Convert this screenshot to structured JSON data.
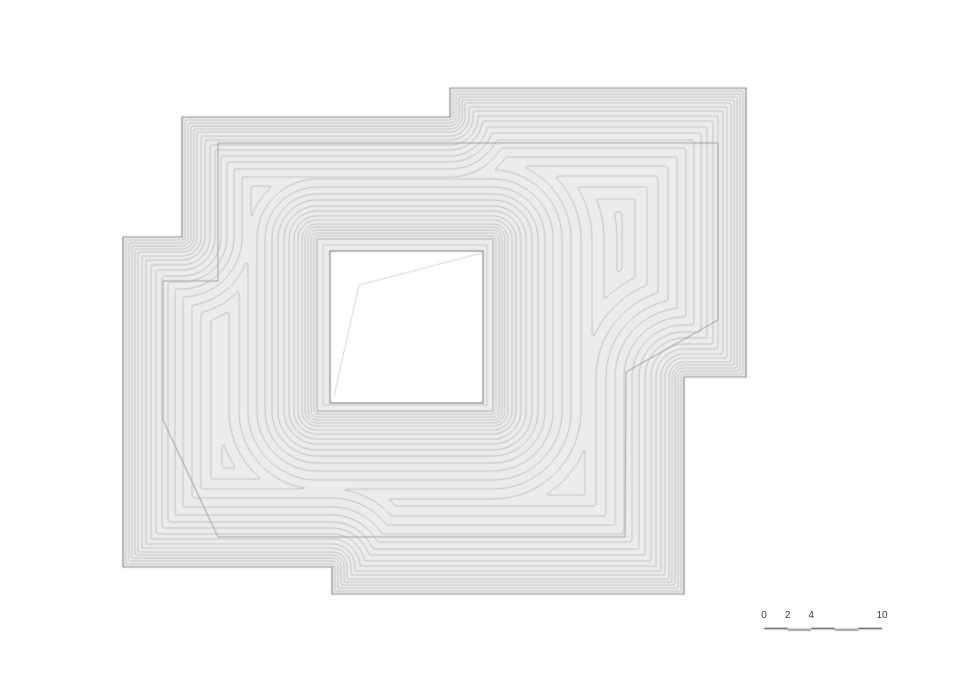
{
  "page": {
    "background": "#ffffff"
  },
  "drawing": {
    "width": 960,
    "height": 678,
    "colors": {
      "fill": "#ececec",
      "contour": "#b6b6b6",
      "ridge": "#a0a0a0",
      "outline": "#878787",
      "courtyard_outer": "#a8a8a8",
      "courtyard_mid": "#bfbfbf",
      "courtyard_inner": "#8a8a8a",
      "courtyard_fill": "#ffffff",
      "faint_line": "#cccccc"
    },
    "outer_polygon": [
      [
        182,
        117
      ],
      [
        450,
        117
      ],
      [
        450,
        88
      ],
      [
        746,
        88
      ],
      [
        746,
        377
      ],
      [
        684,
        377
      ],
      [
        684,
        594
      ],
      [
        332,
        594
      ],
      [
        332,
        567
      ],
      [
        123,
        567
      ],
      [
        123,
        237
      ],
      [
        182,
        237
      ]
    ],
    "ridge_polygon": [
      [
        218,
        143
      ],
      [
        718,
        143
      ],
      [
        718,
        320
      ],
      [
        626,
        372
      ],
      [
        625,
        537
      ],
      [
        218,
        537
      ],
      [
        163,
        420
      ],
      [
        163,
        281
      ],
      [
        218,
        281
      ]
    ],
    "courtyard": {
      "outer_rect": [
        317,
        239,
        493,
        411
      ],
      "mid_rect": [
        323,
        245,
        487,
        405
      ],
      "inner_rect": [
        330,
        251,
        483,
        403
      ],
      "interior_polyline": [
        [
          482,
          253
        ],
        [
          359,
          285
        ],
        [
          334,
          396
        ]
      ]
    },
    "contour_levels": [
      3,
      6,
      9,
      12,
      15,
      19,
      23,
      28,
      33,
      39,
      45,
      52,
      60,
      69,
      78,
      88,
      99,
      111,
      124,
      138
    ],
    "grid_cell": 2,
    "grid_bounds": [
      116,
      82,
      752,
      600
    ]
  },
  "scale_bar": {
    "origin_x": 764,
    "bar_y": 629,
    "px_per_unit": 11.8,
    "marks": [
      {
        "label": "0",
        "unit": 0
      },
      {
        "label": "2",
        "unit": 2
      },
      {
        "label": "4",
        "unit": 4
      },
      {
        "label": "10",
        "unit": 10
      }
    ],
    "segments": [
      {
        "from": 0,
        "to": 2,
        "tone": "dark"
      },
      {
        "from": 2,
        "to": 4,
        "tone": "light"
      },
      {
        "from": 4,
        "to": 6,
        "tone": "dark"
      },
      {
        "from": 6,
        "to": 8,
        "tone": "light"
      },
      {
        "from": 8,
        "to": 10,
        "tone": "dark"
      }
    ],
    "colors": {
      "dark": "#4f4f4f",
      "light": "#9e9e9e",
      "text": "#3a3a3a"
    }
  }
}
